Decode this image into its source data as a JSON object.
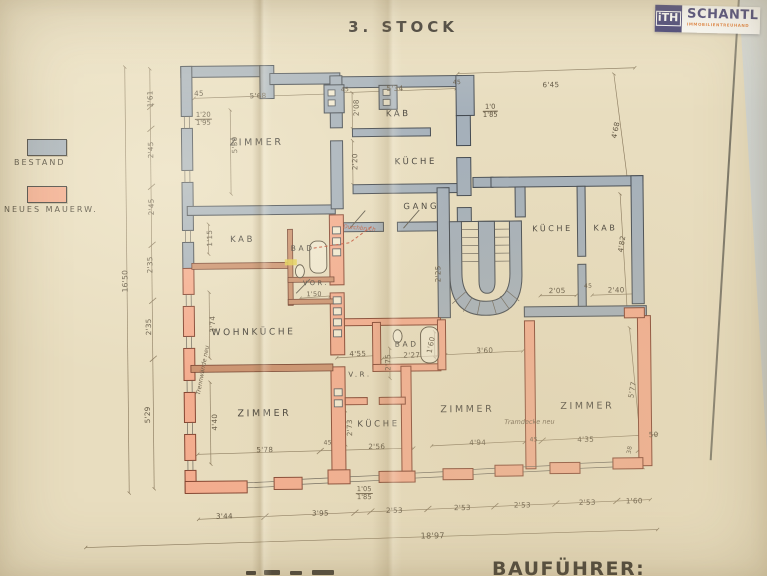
{
  "page": {
    "title": "3. STOCK",
    "bottom_label": "BAUFÜHRER:"
  },
  "logo": {
    "monogram": "iTH",
    "name": "SCHANTL",
    "subtitle": "IMMOBILIENTREUHAND",
    "navy": "#32306b",
    "orange": "#e1782f"
  },
  "legend": {
    "items": [
      {
        "label": "BESTAND",
        "color": "#a5b0ba"
      },
      {
        "label": "NEUES MAUERW.",
        "color": "#f4ac8e"
      }
    ]
  },
  "plan": {
    "colors": {
      "existing_wall": "#a5b0ba",
      "new_wall": "#f4ac8e"
    },
    "rooms": [
      {
        "label": "ZIMMER",
        "x": 258,
        "y": 141
      },
      {
        "label": "KAB",
        "x": 400,
        "y": 114,
        "size": 8.5
      },
      {
        "label": "KÜCHE",
        "x": 417,
        "y": 162,
        "size": 8.5
      },
      {
        "label": "GANG",
        "x": 422,
        "y": 207,
        "size": 8.5
      },
      {
        "label": "KAB",
        "x": 243,
        "y": 238,
        "size": 8.5
      },
      {
        "label": "BAD",
        "x": 303,
        "y": 247,
        "size": 7.5
      },
      {
        "label": "VOR.",
        "x": 316,
        "y": 282,
        "size": 6.5
      },
      {
        "label": "WOHNKÜCHE",
        "x": 253,
        "y": 331,
        "size": 9
      },
      {
        "label": "ZIMMER",
        "x": 263,
        "y": 412
      },
      {
        "label": "V.R.",
        "x": 359,
        "y": 374,
        "size": 7
      },
      {
        "label": "KÜCHE",
        "x": 377,
        "y": 424,
        "size": 8.5
      },
      {
        "label": "BAD",
        "x": 406,
        "y": 344,
        "size": 7.5
      },
      {
        "label": "ZIMMER",
        "x": 466,
        "y": 410
      },
      {
        "label": "ZIMMER",
        "x": 586,
        "y": 408
      },
      {
        "label": "KÜCHE",
        "x": 553,
        "y": 230,
        "size": 8
      },
      {
        "label": "KAB",
        "x": 606,
        "y": 230,
        "size": 8
      }
    ],
    "dims": [
      {
        "text": "45",
        "x": 201,
        "y": 91
      },
      {
        "text": "5'68",
        "x": 260,
        "y": 94
      },
      {
        "text": "1'61",
        "x": 152,
        "y": 96,
        "rot": -90
      },
      {
        "text": "2'45",
        "x": 152,
        "y": 147,
        "rot": -90
      },
      {
        "text": "2'45",
        "x": 152,
        "y": 204,
        "rot": -90
      },
      {
        "text": "2'35",
        "x": 150,
        "y": 262,
        "rot": -90
      },
      {
        "text": "2'35",
        "x": 148,
        "y": 324,
        "rot": -90
      },
      {
        "text": "5'29",
        "x": 146,
        "y": 412,
        "rot": -90
      },
      {
        "text": "16'50",
        "x": 125,
        "y": 278,
        "rot": -90,
        "size": 7.5
      },
      {
        "text": "5'30",
        "x": 236,
        "y": 143,
        "rot": -90
      },
      {
        "text": "45",
        "x": 347,
        "y": 89,
        "size": 6
      },
      {
        "text": "5'34",
        "x": 397,
        "y": 88
      },
      {
        "text": "45",
        "x": 459,
        "y": 83,
        "size": 6
      },
      {
        "text": "6'45",
        "x": 553,
        "y": 86
      },
      {
        "text": "4'68",
        "x": 617,
        "y": 132,
        "rot": -78
      },
      {
        "text": "2'08",
        "x": 358,
        "y": 107,
        "rot": -90
      },
      {
        "text": "2'20",
        "x": 356,
        "y": 161,
        "rot": -90
      },
      {
        "text": "1'15",
        "x": 210,
        "y": 236,
        "rot": -90
      },
      {
        "text": "3'74",
        "x": 212,
        "y": 322,
        "rot": -90
      },
      {
        "text": "4'40",
        "x": 213,
        "y": 420,
        "rot": -90
      },
      {
        "text": "5'78",
        "x": 263,
        "y": 448
      },
      {
        "text": "45",
        "x": 326,
        "y": 442,
        "size": 6
      },
      {
        "text": "2'56",
        "x": 375,
        "y": 446
      },
      {
        "text": "2'75",
        "x": 387,
        "y": 362,
        "rot": -90
      },
      {
        "text": "2'73",
        "x": 348,
        "y": 427,
        "rot": -90
      },
      {
        "text": "4'55",
        "x": 357,
        "y": 353
      },
      {
        "text": "2'27",
        "x": 411,
        "y": 355
      },
      {
        "text": "1'60",
        "x": 430,
        "y": 345,
        "rot": -78
      },
      {
        "text": "3'60",
        "x": 484,
        "y": 351
      },
      {
        "text": "4'94",
        "x": 476,
        "y": 443
      },
      {
        "text": "45",
        "x": 532,
        "y": 441,
        "size": 6
      },
      {
        "text": "4'35",
        "x": 584,
        "y": 441
      },
      {
        "text": "50",
        "x": 652,
        "y": 437
      },
      {
        "text": "5'77",
        "x": 631,
        "y": 392,
        "rot": -80
      },
      {
        "text": "38",
        "x": 628,
        "y": 452,
        "rot": -80,
        "size": 6
      },
      {
        "text": "2'25",
        "x": 438,
        "y": 274,
        "rot": -90
      },
      {
        "text": "2'05",
        "x": 557,
        "y": 292
      },
      {
        "text": "45",
        "x": 588,
        "y": 288,
        "size": 6
      },
      {
        "text": "2'40",
        "x": 616,
        "y": 292
      },
      {
        "text": "4'82",
        "x": 622,
        "y": 246,
        "rot": -80
      },
      {
        "text": "1'50",
        "x": 314,
        "y": 293,
        "size": 6.5
      },
      {
        "text": "18'97",
        "x": 430,
        "y": 536,
        "size": 8
      },
      {
        "text": "3'44",
        "x": 222,
        "y": 514
      },
      {
        "text": "3'95",
        "x": 318,
        "y": 512
      },
      {
        "text": "2'53",
        "x": 392,
        "y": 510
      },
      {
        "text": "2'53",
        "x": 460,
        "y": 508
      },
      {
        "text": "2'53",
        "x": 520,
        "y": 506
      },
      {
        "text": "2'53",
        "x": 585,
        "y": 504
      },
      {
        "text": "1'60",
        "x": 632,
        "y": 503
      }
    ],
    "fractions": [
      {
        "top": "1'20",
        "bottom": "1'95",
        "x": 205,
        "y": 117
      },
      {
        "top": "1'0",
        "bottom": "1'85",
        "x": 492,
        "y": 112
      },
      {
        "top": "1'05",
        "bottom": "1'85",
        "x": 362,
        "y": 493
      }
    ],
    "annotations": [
      {
        "text": "Trennwände neu",
        "x": 202,
        "y": 368,
        "rot": -79,
        "size": 6,
        "italic": true
      },
      {
        "text": "Tramdecke neu",
        "x": 528,
        "y": 423,
        "size": 6.5,
        "italic": true
      },
      {
        "text": "Durchbruch",
        "x": 360,
        "y": 228,
        "rot": 6,
        "size": 5.5,
        "color": "#c05a3a",
        "italic": true
      }
    ]
  }
}
